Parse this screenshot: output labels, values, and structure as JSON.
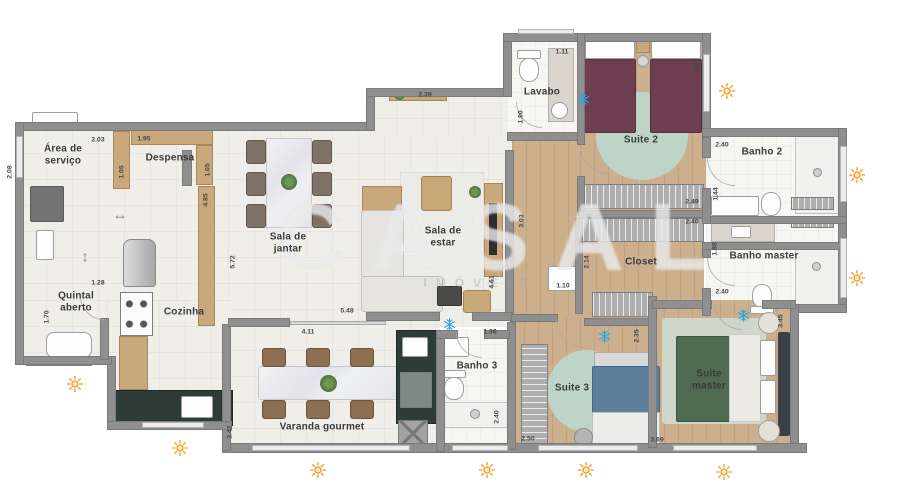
{
  "watermark": {
    "brand": "CASAL",
    "sub": "IMÓVEIS"
  },
  "colors": {
    "wall": "#8f8f8f",
    "tile_floor": "#efeee9",
    "wood_floor": "#ccb08e",
    "bath_floor": "#f6f6f3",
    "mint_rug": "#badbd2",
    "sun": "#ef9a1f",
    "snowflake": "#2aa5de"
  },
  "rooms": [
    {
      "id": "area-servico",
      "label": "Área de\nserviço",
      "x": 63,
      "y": 155
    },
    {
      "id": "despensa",
      "label": "Despensa",
      "x": 170,
      "y": 158
    },
    {
      "id": "quintal-aberto",
      "label": "Quintal\naberto",
      "x": 76,
      "y": 302
    },
    {
      "id": "cozinha",
      "label": "Cozinha",
      "x": 184,
      "y": 312
    },
    {
      "id": "sala-de-jantar",
      "label": "Sala de\njantar",
      "x": 288,
      "y": 243
    },
    {
      "id": "sala-de-estar",
      "label": "Sala de\nestar",
      "x": 443,
      "y": 237
    },
    {
      "id": "lavabo",
      "label": "Lavabo",
      "x": 542,
      "y": 92
    },
    {
      "id": "suite-2",
      "label": "Suite 2",
      "x": 641,
      "y": 140
    },
    {
      "id": "banho-2",
      "label": "Banho 2",
      "x": 762,
      "y": 152
    },
    {
      "id": "closet",
      "label": "Closet",
      "x": 641,
      "y": 262
    },
    {
      "id": "banho-master",
      "label": "Banho master",
      "x": 764,
      "y": 256
    },
    {
      "id": "banho-3",
      "label": "Banho 3",
      "x": 477,
      "y": 366
    },
    {
      "id": "suite-3",
      "label": "Suite 3",
      "x": 572,
      "y": 388
    },
    {
      "id": "suite-master",
      "label": "Suite\nmaster",
      "x": 709,
      "y": 380
    },
    {
      "id": "varanda-gourmet",
      "label": "Varanda gourmet",
      "x": 322,
      "y": 427
    }
  ],
  "dimensions": [
    {
      "text": "2.03",
      "x": 98,
      "y": 140
    },
    {
      "text": "1.95",
      "x": 144,
      "y": 139
    },
    {
      "text": "2.08",
      "x": 10,
      "y": 172,
      "vertical": true
    },
    {
      "text": "1.05",
      "x": 122,
      "y": 172,
      "vertical": true
    },
    {
      "text": "1.05",
      "x": 208,
      "y": 170,
      "vertical": true
    },
    {
      "text": "4.85",
      "x": 206,
      "y": 200,
      "vertical": true
    },
    {
      "text": "1.28",
      "x": 98,
      "y": 283
    },
    {
      "text": "1.70",
      "x": 47,
      "y": 317,
      "vertical": true
    },
    {
      "text": "5.72",
      "x": 233,
      "y": 262,
      "vertical": true
    },
    {
      "text": "2.39",
      "x": 425,
      "y": 95
    },
    {
      "text": "1.80",
      "x": 521,
      "y": 117,
      "vertical": true
    },
    {
      "text": "1.11",
      "x": 562,
      "y": 52
    },
    {
      "text": "3.53",
      "x": 697,
      "y": 66,
      "vertical": true
    },
    {
      "text": "2.40",
      "x": 722,
      "y": 145
    },
    {
      "text": "1.44",
      "x": 716,
      "y": 194,
      "vertical": true
    },
    {
      "text": "2.49",
      "x": 692,
      "y": 202
    },
    {
      "text": "2.40",
      "x": 692,
      "y": 222
    },
    {
      "text": "2.14",
      "x": 587,
      "y": 262,
      "vertical": true
    },
    {
      "text": "1.88",
      "x": 715,
      "y": 249,
      "vertical": true
    },
    {
      "text": "2.40",
      "x": 722,
      "y": 292
    },
    {
      "text": "3.03",
      "x": 522,
      "y": 221,
      "vertical": true
    },
    {
      "text": "4.61",
      "x": 492,
      "y": 282,
      "vertical": true
    },
    {
      "text": "1.10",
      "x": 563,
      "y": 286
    },
    {
      "text": "1.36",
      "x": 490,
      "y": 332
    },
    {
      "text": "2.40",
      "x": 497,
      "y": 417,
      "vertical": true
    },
    {
      "text": "2.50",
      "x": 528,
      "y": 439
    },
    {
      "text": "2.35",
      "x": 637,
      "y": 336,
      "vertical": true
    },
    {
      "text": "5.48",
      "x": 347,
      "y": 311
    },
    {
      "text": "4.11",
      "x": 308,
      "y": 332
    },
    {
      "text": "2.42",
      "x": 230,
      "y": 432,
      "vertical": true
    },
    {
      "text": "3.69",
      "x": 657,
      "y": 440
    },
    {
      "text": "3.45",
      "x": 781,
      "y": 321,
      "vertical": true
    }
  ],
  "arrows": [
    {
      "glyph": "↔",
      "x": 120,
      "y": 215
    },
    {
      "glyph": "↕",
      "x": 85,
      "y": 257
    },
    {
      "glyph": "↕",
      "x": 288,
      "y": 321
    },
    {
      "glyph": "↔",
      "x": 226,
      "y": 353
    }
  ],
  "climate_icons": {
    "sun": [
      {
        "x": 719,
        "y": 83
      },
      {
        "x": 849,
        "y": 167
      },
      {
        "x": 849,
        "y": 270
      },
      {
        "x": 67,
        "y": 376
      },
      {
        "x": 172,
        "y": 440
      },
      {
        "x": 310,
        "y": 462
      },
      {
        "x": 479,
        "y": 462
      },
      {
        "x": 578,
        "y": 462
      },
      {
        "x": 716,
        "y": 464
      }
    ],
    "snowflake": [
      {
        "x": 577,
        "y": 93
      },
      {
        "x": 443,
        "y": 318
      },
      {
        "x": 598,
        "y": 330
      },
      {
        "x": 737,
        "y": 309
      }
    ]
  }
}
